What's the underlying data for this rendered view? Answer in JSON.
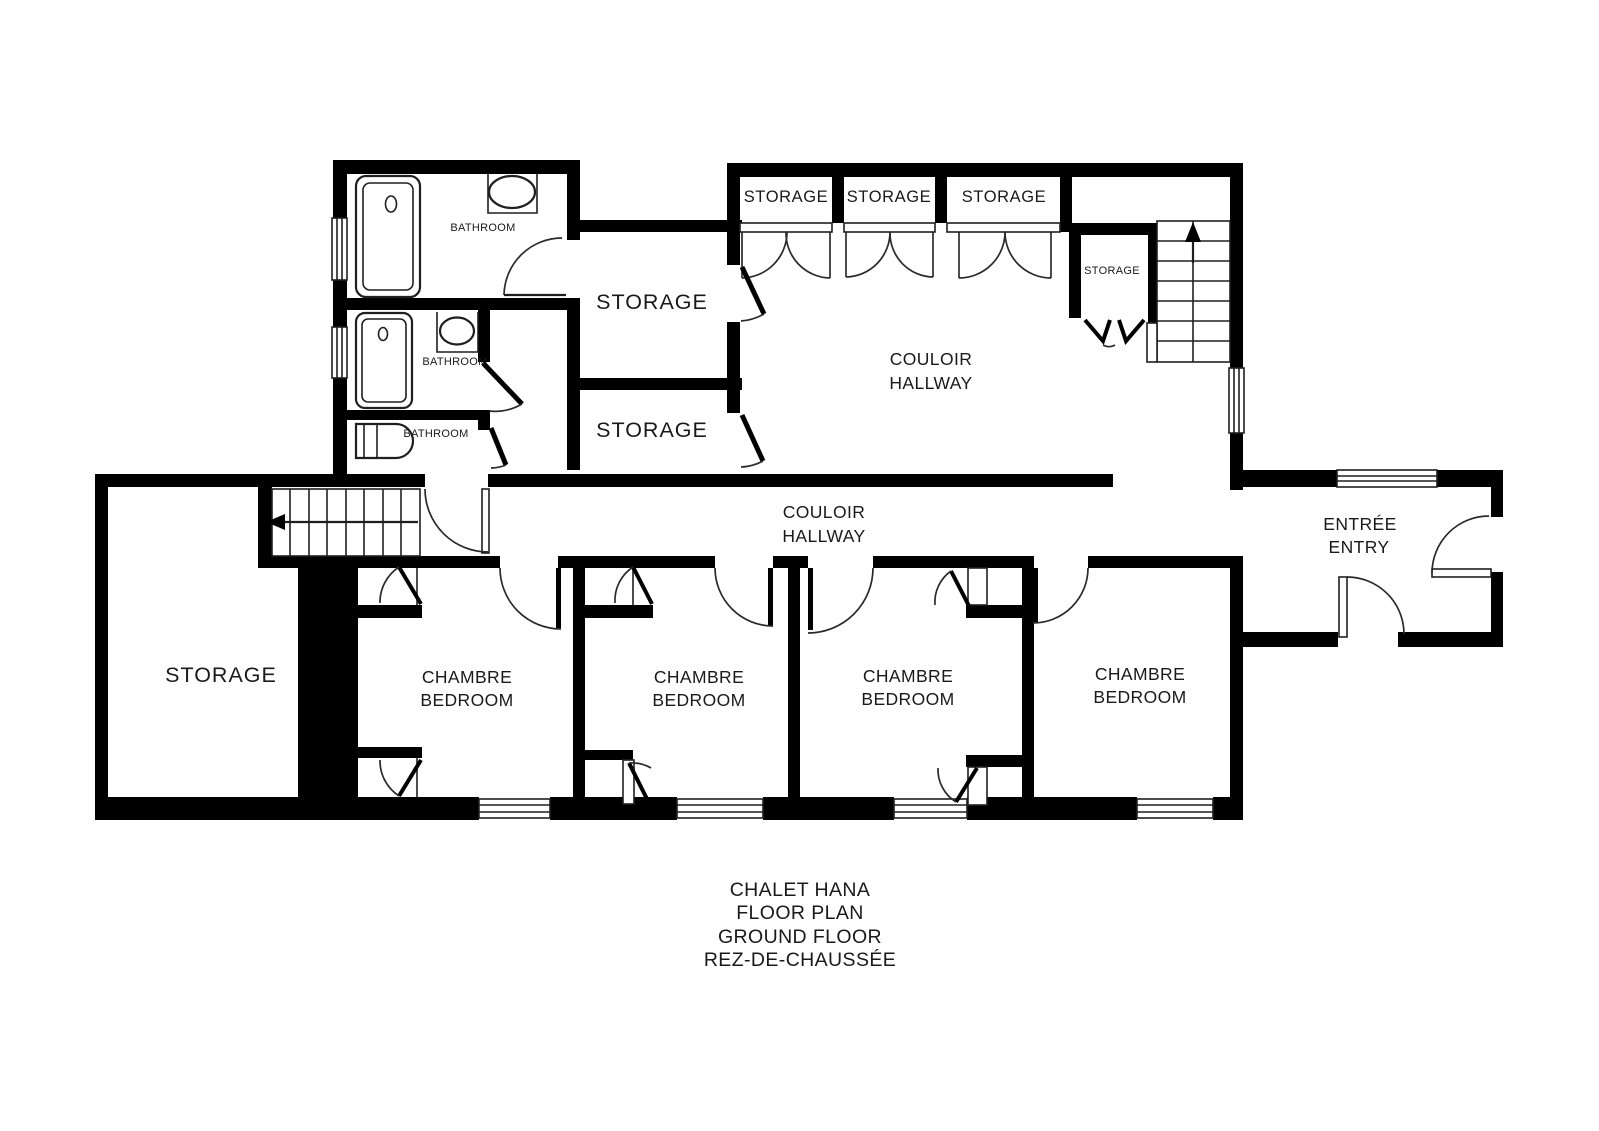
{
  "colors": {
    "background": "#ffffff",
    "wall": "#000000",
    "line": "#1f1f1f",
    "text": "#1a1a1a"
  },
  "plan": {
    "bathrooms": {
      "top": "BATHROOM",
      "middle": "BATHROOM",
      "lower": "BATHROOM"
    },
    "storages": {
      "upper": "STORAGE",
      "lower": "STORAGE",
      "left": "STORAGE",
      "small": "STORAGE",
      "closet1": "STORAGE",
      "closet2": "STORAGE",
      "closet3": "STORAGE"
    },
    "hallway_upper": {
      "l1": "COULOIR",
      "l2": "HALLWAY"
    },
    "hallway_main": {
      "l1": "COULOIR",
      "l2": "HALLWAY"
    },
    "entry": {
      "l1": "ENTRÉE",
      "l2": "ENTRY"
    },
    "bedrooms": [
      {
        "l1": "CHAMBRE",
        "l2": "BEDROOM"
      },
      {
        "l1": "CHAMBRE",
        "l2": "BEDROOM"
      },
      {
        "l1": "CHAMBRE",
        "l2": "BEDROOM"
      },
      {
        "l1": "CHAMBRE",
        "l2": "BEDROOM"
      }
    ],
    "title": {
      "l1": "CHALET HANA",
      "l2": "FLOOR PLAN",
      "l3": "GROUND FLOOR",
      "l4": "REZ-DE-CHAUSSÉE"
    }
  }
}
